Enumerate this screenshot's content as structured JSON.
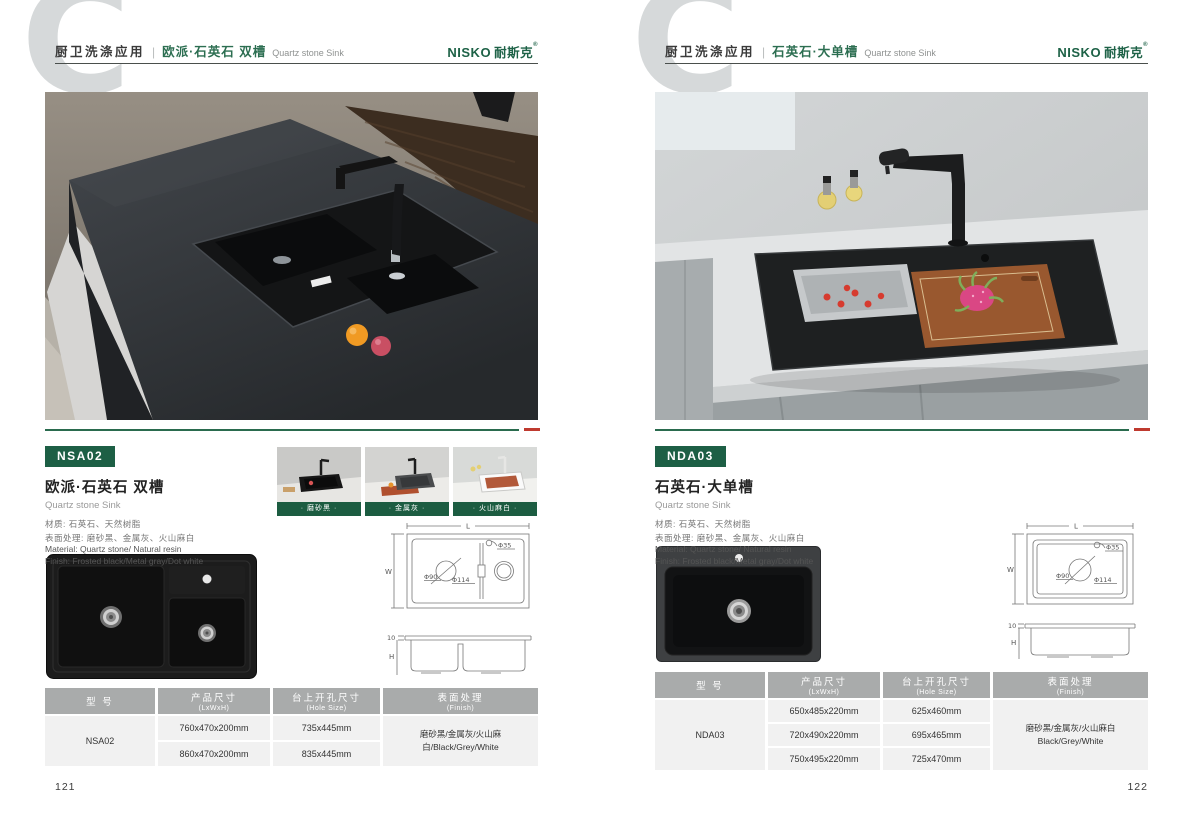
{
  "brand": {
    "name": "NISKO",
    "name_cn": "耐斯克",
    "reg": "®"
  },
  "theme": {
    "brand_green": "#1d5f45",
    "header_title_green": "#2c6e51",
    "accent_red": "#bf3a2f",
    "table_header_gray": "#a9abab",
    "swatch_label_green": "#1c5c41"
  },
  "pages": [
    {
      "page_number": "121",
      "header": {
        "watermark": "C",
        "category": "厨卫洗涤应用",
        "separator": "|",
        "title_cn": "欧派·石英石 双槽",
        "title_en": "Quartz stone Sink"
      },
      "product": {
        "model": "NSA02",
        "name_cn": "欧派·石英石 双槽",
        "name_en": "Quartz stone Sink",
        "material_cn": "材质: 石英石、天然树脂",
        "surface_cn": "表面处理: 磨砂黑、金属灰、火山麻白",
        "material_en": "Material: Quartz stone/ Natural resin",
        "finish_en": "Finish: Frosted black/Metal gray/Dot white"
      },
      "swatches": [
        {
          "label": "· 磨砂黑 ·"
        },
        {
          "label": "· 金属灰 ·"
        },
        {
          "label": "· 火山麻白 ·"
        }
      ],
      "drawing": {
        "dim_length": "L",
        "dim_width": "W",
        "dim_faucet_hole": "Φ35",
        "dim_drain": "Φ90",
        "dim_drain_outer": "Φ114",
        "dim_rim": "10",
        "dim_height": "H"
      },
      "table": {
        "col_model_cn": "型 号",
        "col_model_en": "",
        "col_size_cn": "产品尺寸",
        "col_size_en": "(LxWxH)",
        "col_hole_cn": "台上开孔尺寸",
        "col_hole_en": "(Hole Size)",
        "col_finish_cn": "表面处理",
        "col_finish_en": "(Finish)",
        "model": "NSA02",
        "rows": [
          {
            "size": "760x470x200mm",
            "hole": "735x445mm"
          },
          {
            "size": "860x470x200mm",
            "hole": "835x445mm"
          }
        ],
        "finish_line1": "磨砂黑/金属灰/火山麻白/Black/Grey/White",
        "finish_line2": ""
      }
    },
    {
      "page_number": "122",
      "header": {
        "watermark": "C",
        "category": "厨卫洗涤应用",
        "separator": "|",
        "title_cn": "石英石·大单槽",
        "title_en": "Quartz stone Sink"
      },
      "product": {
        "model": "NDA03",
        "name_cn": "石英石·大单槽",
        "name_en": "Quartz stone Sink",
        "material_cn": "材质: 石英石、天然树脂",
        "surface_cn": "表面处理: 磨砂黑、金属灰、火山麻白",
        "material_en": "Material: Quartz stone/ Natural resin",
        "finish_en": "Finish: Frosted black/Metal gray/Dot white"
      },
      "drawing": {
        "dim_length": "L",
        "dim_width": "W",
        "dim_faucet_hole": "Φ35",
        "dim_drain": "Φ90",
        "dim_drain_outer": "Φ114",
        "dim_rim": "10",
        "dim_height": "H"
      },
      "table": {
        "col_model_cn": "型 号",
        "col_model_en": "",
        "col_size_cn": "产品尺寸",
        "col_size_en": "(LxWxH)",
        "col_hole_cn": "台上开孔尺寸",
        "col_hole_en": "(Hole Size)",
        "col_finish_cn": "表面处理",
        "col_finish_en": "(Finish)",
        "model": "NDA03",
        "rows": [
          {
            "size": "650x485x220mm",
            "hole": "625x460mm"
          },
          {
            "size": "720x490x220mm",
            "hole": "695x465mm"
          },
          {
            "size": "750x495x220mm",
            "hole": "725x470mm"
          }
        ],
        "finish_line1": "磨砂黑/金属灰/火山麻白",
        "finish_line2": "Black/Grey/White"
      }
    }
  ]
}
